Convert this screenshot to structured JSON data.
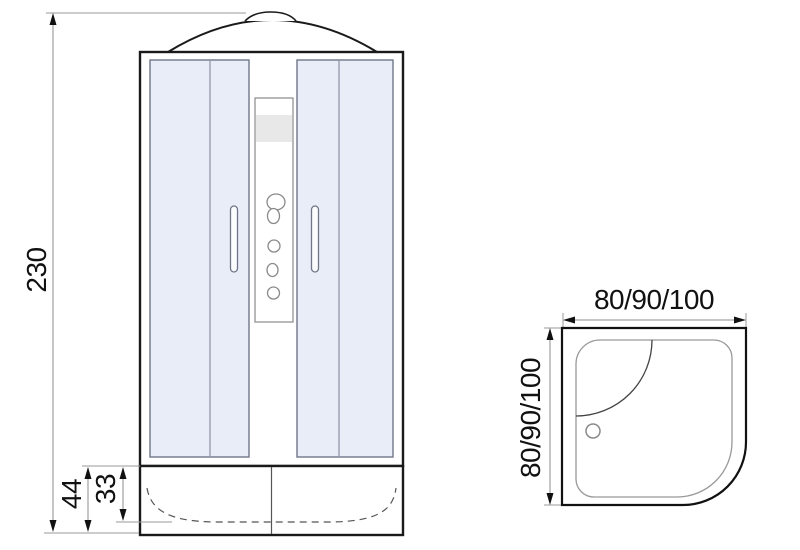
{
  "front_view": {
    "overall_height": "230",
    "tray_height": "44",
    "basin_depth": "33"
  },
  "top_view": {
    "width_sizes": "80/90/100",
    "depth_sizes": "80/90/100"
  },
  "colors": {
    "line": "#1a1a1a",
    "dimension_line": "#8c8c8c",
    "glass_fill": "#e9edf8",
    "glass_border": "#6e7687",
    "reflection": "#8590aa",
    "panel_band": "#e8e8e8"
  }
}
